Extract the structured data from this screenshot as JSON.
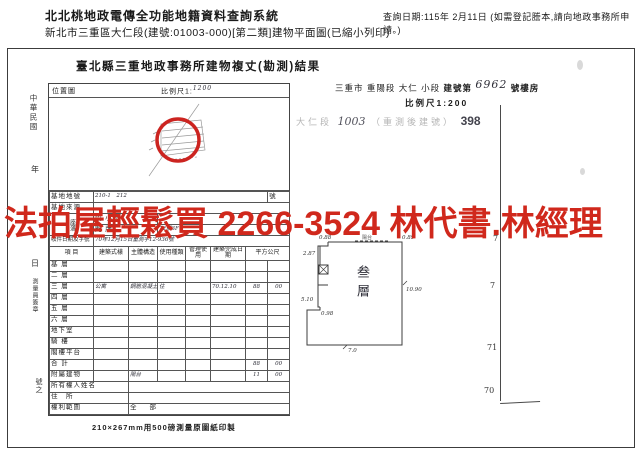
{
  "header": {
    "system_title": "北北桃地政電傳全功能地籍資料查詢系統",
    "query_date": "查詢日期:115年 2月11日 (如需登記謄本,請向地政事務所申請。)",
    "doc_line": "新北市三重區大仁段(建號:01003-000)[第二類]建物平面圖(已縮小列印)"
  },
  "watermark": {
    "text": "法拍屋輕鬆買 2266-3524 林代書.林經理",
    "color": "#d0281c"
  },
  "form": {
    "title": "臺北縣三重地政事務所建物複丈(勘測)結果",
    "margin": {
      "era": "中華民國",
      "year": "年",
      "day": "日",
      "surveyor": "測量員簽章",
      "serial": "號之"
    },
    "location": {
      "label": "位置圖",
      "scale_prefix": "比例尺1:",
      "scale_value": "1200"
    },
    "fields": {
      "site_no_label": "基地地號",
      "site_no_value": "210-1　212",
      "unit": "號",
      "site_src_label": "基地來源",
      "seat_label": "座落",
      "seat_sub1": "段 小段",
      "door_label": "門 牌",
      "door_value": "72號3F",
      "receipt_label": "收件日期及字號",
      "receipt_value": "70年12月15日重測字12-936號"
    },
    "table": {
      "headers": [
        "項 目",
        "建築式樣",
        "主體構造",
        "使用種類",
        "管理使用",
        "建築完成日期",
        "平方公尺"
      ],
      "rows": [
        {
          "label": "基 層",
          "cells": [
            "",
            "",
            "",
            "",
            ""
          ],
          "a": "",
          "b": ""
        },
        {
          "label": "二 層",
          "cells": [
            "",
            "",
            "",
            "",
            ""
          ],
          "a": "",
          "b": ""
        },
        {
          "label": "三 層",
          "cells": [
            "公寓",
            "鋼筋混凝土",
            "住",
            "",
            "70.12.10"
          ],
          "a": "88",
          "b": "00"
        },
        {
          "label": "四 層",
          "cells": [
            "",
            "",
            "",
            "",
            ""
          ],
          "a": "",
          "b": ""
        },
        {
          "label": "五 層",
          "cells": [
            "",
            "",
            "",
            "",
            ""
          ],
          "a": "",
          "b": ""
        },
        {
          "label": "六 層",
          "cells": [
            "",
            "",
            "",
            "",
            ""
          ],
          "a": "",
          "b": ""
        },
        {
          "label": "地下室",
          "cells": [
            "",
            "",
            "",
            "",
            ""
          ],
          "a": "",
          "b": ""
        },
        {
          "label": "騎 樓",
          "cells": [
            "",
            "",
            "",
            "",
            ""
          ],
          "a": "",
          "b": ""
        },
        {
          "label": "閣樓平台",
          "cells": [
            "",
            "",
            "",
            "",
            ""
          ],
          "a": "",
          "b": ""
        },
        {
          "label": "合 計",
          "cells": [
            "",
            "",
            "",
            "",
            ""
          ],
          "a": "88",
          "b": "00"
        },
        {
          "label": "附屬建物",
          "cells": [
            "",
            "陽台",
            "",
            "",
            ""
          ],
          "a": "11",
          "b": "00"
        }
      ],
      "owner_label": "所有權人姓名",
      "addr_label": "住　所",
      "rights_label": "權利範圍",
      "rights_value": "全　　部"
    },
    "footer_note": "210×267mm用500磅測量原圖紙印製"
  },
  "right": {
    "line1_prefix": "三重市",
    "line1_seg": "重陽段",
    "line1_sub": "大仁 小段",
    "line1_no": "建號第",
    "line1_no_value": "6962",
    "line1_suffix": "號樓房",
    "scale": "比例尺1:200",
    "stamp_seg": "大仁段",
    "stamp_no1": "1003",
    "stamp_mid": "（重測後建號）",
    "stamp_no2": "398"
  },
  "plan": {
    "floor_label": "叁層",
    "balcony_label": "陽台",
    "dims": [
      {
        "t": "0.88",
        "x": 24,
        "y": 10
      },
      {
        "t": "2.87",
        "x": 8,
        "y": 26
      },
      {
        "t": "5.10",
        "x": 6,
        "y": 72
      },
      {
        "t": "0.98",
        "x": 26,
        "y": 86
      },
      {
        "t": "7.0",
        "x": 53,
        "y": 123
      },
      {
        "t": "10.90",
        "x": 111,
        "y": 62
      },
      {
        "t": "0.89",
        "x": 107,
        "y": 10
      }
    ]
  },
  "fold_marks": [
    {
      "t": "7",
      "x": 493,
      "y": 234
    },
    {
      "t": "7",
      "x": 490,
      "y": 281
    },
    {
      "t": "71",
      "x": 487,
      "y": 343
    },
    {
      "t": "70",
      "x": 484,
      "y": 386
    }
  ]
}
